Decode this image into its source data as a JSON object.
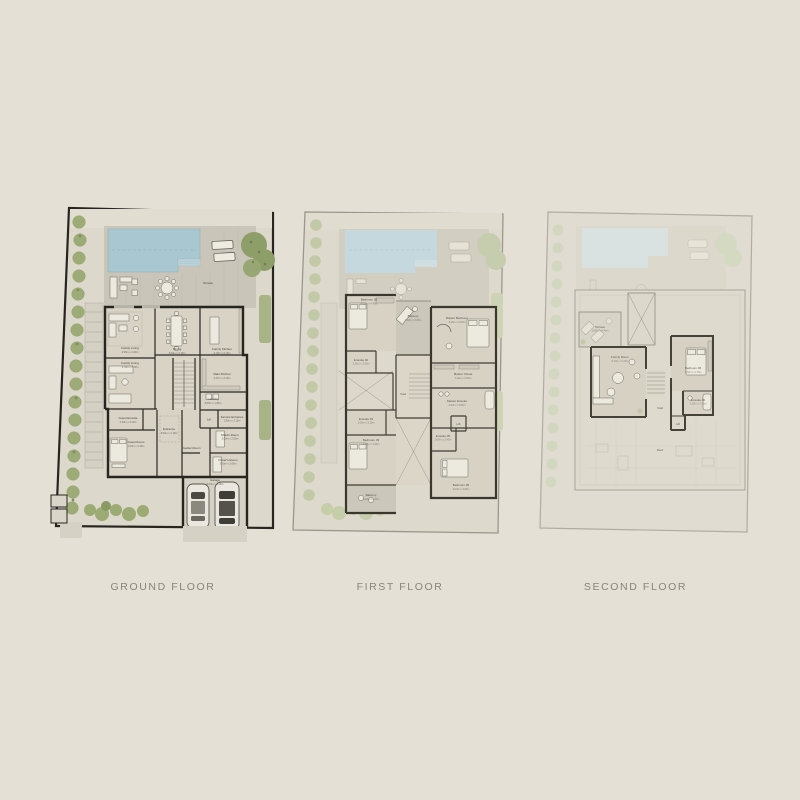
{
  "page": {
    "background": "#e4e0d6"
  },
  "colors": {
    "plot_border": "#26251f",
    "walls": "#26251f",
    "pool": "#a9c7d1",
    "vegetation": "#9dab76",
    "deck": "#c9c5b8",
    "title_text": "#8b8377"
  },
  "floors": [
    {
      "id": "ground",
      "label": "GROUND FLOOR",
      "rooms": {
        "terrace": {
          "name": "Terrace",
          "dims": ""
        },
        "family_living": {
          "name": "Family Living",
          "dims": "4.95m x 4.60m"
        },
        "family_living_2": {
          "name": "Family Living",
          "dims": "3.70m x 3.70m"
        },
        "dining": {
          "name": "Dining",
          "dims": "3.60m x 4.10m"
        },
        "family_kitchen": {
          "name": "Family Kitchen",
          "dims": "4.10m x 4.10m"
        },
        "main_kitchen": {
          "name": "Main Kitchen",
          "dims": "2.47m x 3.10m"
        },
        "laundry": {
          "name": "Laundry",
          "dims": "3.05m x 1.80m"
        },
        "lift": {
          "name": "Lift",
          "dims": ""
        },
        "service_entrance": {
          "name": "Service Entrance",
          "dims": "1.80m x 3.10m"
        },
        "guest_ensuite": {
          "name": "Guest Ensuite",
          "dims": "2.30m x 3.10m"
        },
        "guest_room": {
          "name": "Guest Room",
          "dims": "4.00m x 4.40m"
        },
        "entrance": {
          "name": "Entrance",
          "dims": "3.50m x 4.10m"
        },
        "powder_room": {
          "name": "Powder Room",
          "dims": ""
        },
        "maids_room": {
          "name": "Maid's Room",
          "dims": "3.00m x 2.60m"
        },
        "drivers_room": {
          "name": "Driver's Room",
          "dims": "3.00m x 2.60m"
        },
        "garage": {
          "name": "Garage",
          "dims": "6.00m x 6.10m"
        }
      }
    },
    {
      "id": "first",
      "label": "FIRST FLOOR",
      "rooms": {
        "bedroom_02": {
          "name": "Bedroom 02",
          "dims": "4.00m x 4.40m"
        },
        "ensuite_02": {
          "name": "Ensuite 02",
          "dims": "2.30m x 3.00m"
        },
        "balcony": {
          "name": "Balcony",
          "dims": "3.00m x 3.00m"
        },
        "master_bedroom": {
          "name": "Master Bedroom",
          "dims": "4.00m x 5.00m"
        },
        "master_closet": {
          "name": "Master Closet",
          "dims": "2.40m x 3.50m"
        },
        "master_ensuite": {
          "name": "Master Ensuite",
          "dims": "3.00m x 3.80m"
        },
        "void": {
          "name": "Void",
          "dims": ""
        },
        "ensuite_03": {
          "name": "Ensuite 03",
          "dims": "2.00m x 3.10m"
        },
        "bedroom_03": {
          "name": "Bedroom 03",
          "dims": "4.20m x 4.40m"
        },
        "balcony_2": {
          "name": "Balcony",
          "dims": "3.10m x 4.40m"
        },
        "ensuite_05": {
          "name": "Ensuite 05",
          "dims": "2.00m x 2.40m"
        },
        "bedroom_05": {
          "name": "Bedroom 05",
          "dims": "4.00m x 3.80m"
        },
        "lift": {
          "name": "Lift",
          "dims": ""
        }
      }
    },
    {
      "id": "second",
      "label": "SECOND FLOOR",
      "rooms": {
        "terrace": {
          "name": "Terrace",
          "dims": "3.85m x 4.40m"
        },
        "family_room": {
          "name": "Family Room",
          "dims": "5.40m x 5.00m"
        },
        "bedroom_06": {
          "name": "Bedroom 06",
          "dims": "3.60m x 4.70m"
        },
        "ensuite_06": {
          "name": "Ensuite 06",
          "dims": "2.35m x 2.40m"
        },
        "lift": {
          "name": "Lift",
          "dims": ""
        },
        "void": {
          "name": "Void",
          "dims": ""
        },
        "roof": {
          "name": "Roof",
          "dims": ""
        }
      }
    }
  ]
}
